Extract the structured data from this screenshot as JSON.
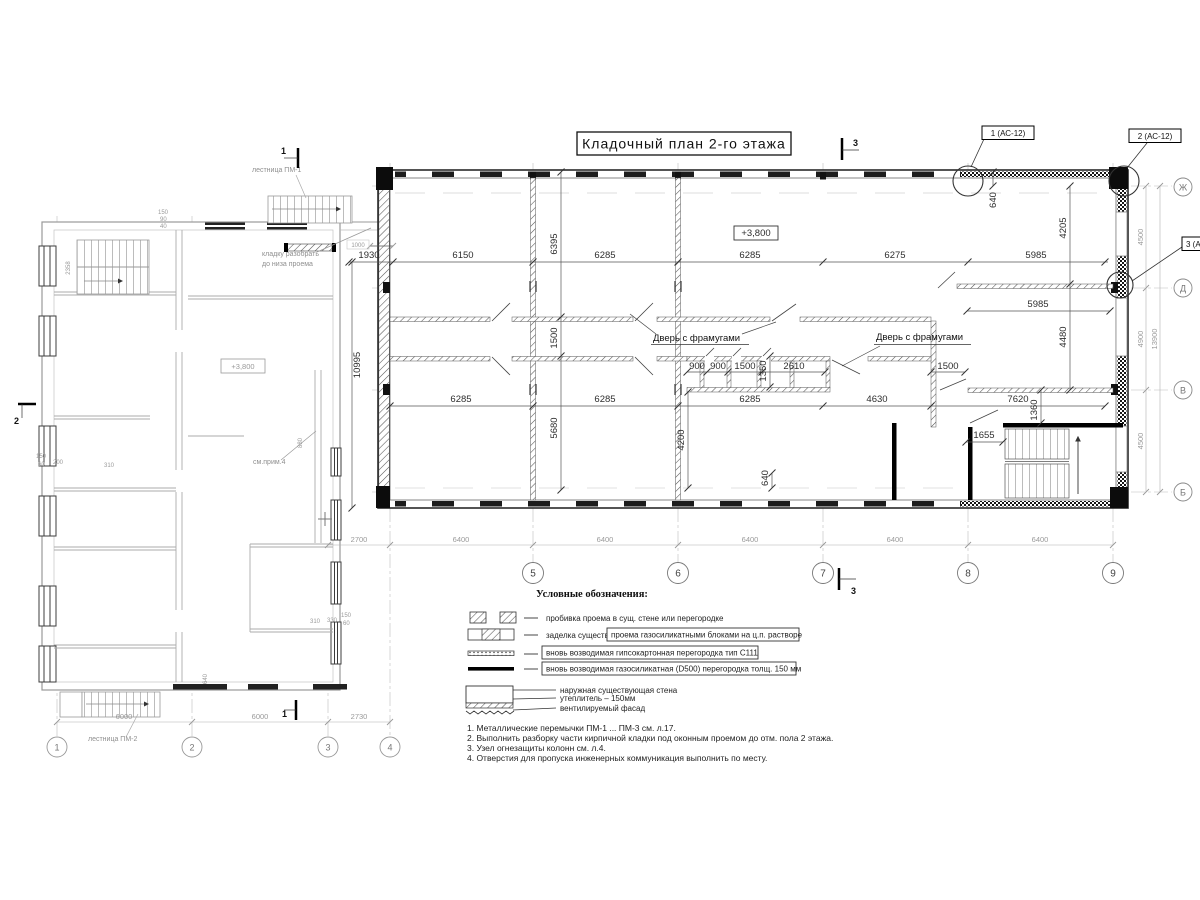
{
  "title": "Кладочный план 2-го этажа",
  "axes": {
    "main_bottom": [
      "5",
      "6",
      "7",
      "8",
      "9"
    ],
    "left_bottom": [
      "1",
      "2",
      "3",
      "4"
    ],
    "right": [
      "Ж",
      "Д",
      "В",
      "Б"
    ]
  },
  "details": [
    "1 (АС-12)",
    "2 (АС-12)",
    "3 (АС-12)"
  ],
  "levels": {
    "main": "+3,800",
    "left": "+3,800"
  },
  "door_labels": [
    "Дверь с фрамугами",
    "Дверь с фрамугами"
  ],
  "stairs": {
    "pm1": "лестница ПМ-1",
    "pm2": "лестница ПМ-2"
  },
  "annotations": {
    "demolish1": "кладку разобрать",
    "demolish2": "до низа проема",
    "see_note": "см.прим.4"
  },
  "sections": {
    "s1": "1",
    "s2": "2",
    "s3": "3"
  },
  "dims": {
    "row_top": [
      "1930",
      "6150",
      "6285",
      "6285",
      "6275",
      "5985"
    ],
    "row_top2": "5985",
    "row_mid": [
      "6285",
      "6285",
      "6285",
      "4630",
      "7620"
    ],
    "row_wc": [
      "900",
      "900",
      "1500",
      "2610"
    ],
    "wc_right": "1500",
    "stair": "1655",
    "v10995": "10995",
    "v6395": "6395",
    "v1500": "1500",
    "v5680": "5680",
    "v4200": "4200",
    "v640a": "640",
    "v640b": "640",
    "v1350": "1350",
    "v1360": "1360",
    "v4205": "4205",
    "v4480": "4480",
    "row_bottom": [
      "2700",
      "6400",
      "6400",
      "6400",
      "6400",
      "6400"
    ],
    "right_col": [
      "4500",
      "4900",
      "4500",
      "13900"
    ],
    "left_row": [
      "6000",
      "6000",
      "2730"
    ],
    "tiny": {
      "t1000": "1000",
      "t2358": "2358",
      "t880": "880",
      "t640": "640",
      "lc": [
        "150",
        "60",
        "200",
        "310"
      ],
      "rc": [
        "310",
        "330",
        "150",
        "60"
      ],
      "tc": [
        "150",
        "90",
        "40"
      ]
    }
  },
  "legend": {
    "title": "Условные обозначения:",
    "item1": "пробивка проема  в сущ. стене  или перегородке",
    "item2a": "заделка существ.",
    "item2b": "проема газосиликатными блоками на ц.п. растворе",
    "item3": "вновь возводимая гипсокартонная перегородка тип С111",
    "item4": "вновь возводимая газосиликатная (D500) перегородка толщ. 150 мм",
    "item5a": "наружная существующая стена",
    "item5b": "утеплитель – 150мм",
    "item5c": "вентилируемый фасад"
  },
  "notes": [
    "1. Металлические перемычки  ПМ-1 ... ПМ-3 см. л.17.",
    "2. Выполнить разборку части кирпичной кладки под оконным проемом до отм. пола 2 этажа.",
    "3. Узел огнезащиты колонн см. л.4.",
    "4. Отверстия для пропуска инженерных коммуникация выполнить по месту."
  ]
}
